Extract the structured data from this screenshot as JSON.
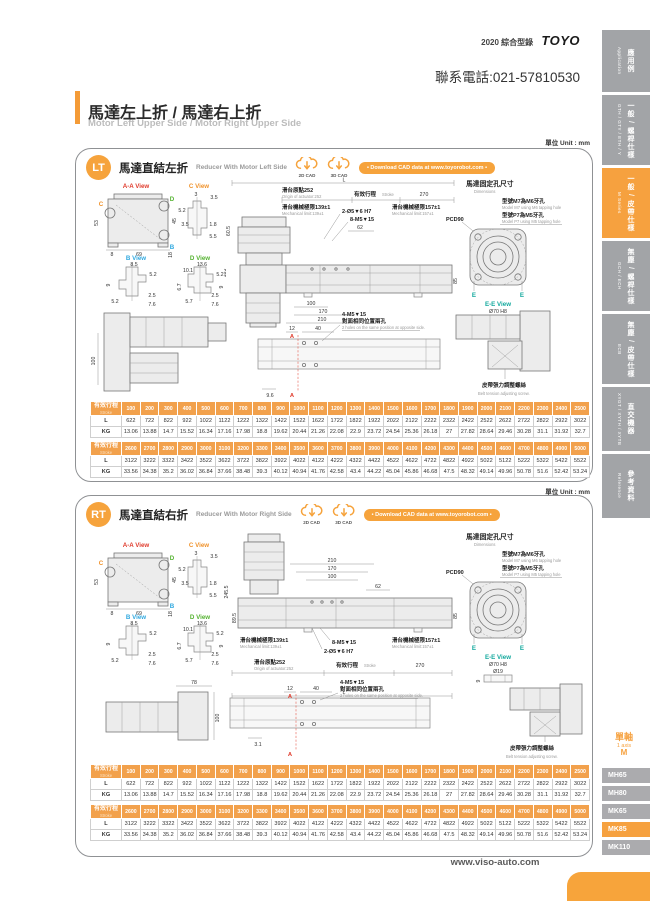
{
  "page": {
    "catalog": "2020  綜合型錄",
    "logo": "TOYO",
    "phone": "聯系電話:021-57810530",
    "title_zh": "馬達左上折 / 馬達右上折",
    "title_en": "Motor Left Upper Side / Motor Right Upper Side",
    "unit": "單位 Unit : mm",
    "footer": "www.viso-auto.com"
  },
  "sidebar": {
    "tabs": [
      {
        "zh": "應用例",
        "en": "Application"
      },
      {
        "zh": "一般 / 螺桿仕樣",
        "en": "GTH / GTY / ETH / Y"
      },
      {
        "zh": "一般 / 皮帶仕樣",
        "en": "M Series"
      },
      {
        "zh": "無塵 / 螺桿仕樣",
        "en": "GCH / ECH"
      },
      {
        "zh": "無塵 / 皮帶仕樣",
        "en": "ECB"
      },
      {
        "zh": "直交機器",
        "en": "XYGT / XYTH / XYTB"
      },
      {
        "zh": "參考資料",
        "en": "Reference"
      }
    ],
    "axis": {
      "zh": "單軸",
      "en": "1 axis",
      "series": "M"
    },
    "models": [
      {
        "label": "MH65"
      },
      {
        "label": "MH80"
      },
      {
        "label": "MK65"
      },
      {
        "label": "MK85"
      },
      {
        "label": "MK110"
      }
    ]
  },
  "panel_lt": {
    "badge": "LT",
    "title_zh": "馬達直結左折",
    "title_en": "Reducer With Motor Left Side",
    "cad2d": "2D CAD",
    "cad3d": "3D CAD",
    "download": "• Download CAD data at www.toyorobot.com •"
  },
  "panel_rt": {
    "badge": "RT",
    "title_zh": "馬達直結右折",
    "title_en": "Reducer With Motor Right Side",
    "cad2d": "2D CAD",
    "cad3d": "3D CAD",
    "download": "• Download CAD data at www.toyorobot.com •"
  },
  "views": {
    "aa": {
      "label": "A-A View",
      "d53": "53",
      "d45": "45",
      "d8": "8",
      "d69": "69",
      "d18": "18",
      "mc": "C",
      "md": "D",
      "mb": "B"
    },
    "c": {
      "label": "C View",
      "d3": "3",
      "d35a": "3.5",
      "d52": "5.2",
      "d35b": "3.5",
      "d18": "1.8",
      "d55": "5.5"
    },
    "b": {
      "label": "B View",
      "d85": "8.5",
      "d52a": "5.2",
      "d9": "9",
      "d52b": "5.2",
      "d25": "2.5",
      "d76": "7.6"
    },
    "d": {
      "label": "D View",
      "d136": "13.6",
      "d101": "10.1",
      "d52a": "5.2",
      "d67": "6.7",
      "d9": "9",
      "d57": "5.7",
      "d25": "2.5",
      "d76": "7.6"
    }
  },
  "mount": {
    "title_zh": "馬達固定孔尺寸",
    "title_en": "Dimensions",
    "m7_zh": "型號M7為M6牙孔",
    "m7_en": "Model M7 using M6 tapping hole",
    "p7_zh": "型號P7為M5牙孔",
    "p7_en": "Model P7 using M5 tapping hole",
    "pcd": "PCD90",
    "e": "E",
    "ee_label": "E-E View",
    "d70": "Ø70 H8",
    "d19": "Ø19",
    "d9": "9"
  },
  "drawing": {
    "l": "L",
    "origin_zh": "滑台原點252",
    "origin_en": "Origin of actuator:252",
    "stroke_zh": "有效行程",
    "stroke_en": "Stroke",
    "d270": "270",
    "mech139_zh": "滑台機械極限139±1",
    "mech139_en": "Mechanical limit:139±1",
    "mech157_zh": "滑台機械極限157±1",
    "mech157_en": "Mechanical limit:157±1",
    "holes_pin": "2-Ø5▼6 H7",
    "holes_m5": "8-M5▼15",
    "d62": "62",
    "d100": "100",
    "d170": "170",
    "d210": "210",
    "d85": "85",
    "d183": "183",
    "d605": "60.5",
    "d2455": "245.5",
    "d895": "89.5",
    "d12": "12",
    "d40": "40",
    "d96": "9.6",
    "d31": "3.1",
    "d78": "78",
    "d100b": "100",
    "m5x4_l1": "4-M5▼15",
    "m5x4_l2": "對面相同位置兩孔",
    "m5x4_en": "2 holes on the same position at opposite side.",
    "belt_zh": "皮帶張力調整螺絲",
    "belt_en": "Belt tension adjusting screw.",
    "a": "A"
  },
  "stroke_table": {
    "header_zh": "有效行程",
    "header_en": "Stroke",
    "row_l": "L",
    "row_kg": "KG",
    "strokes1": [
      100,
      200,
      300,
      400,
      500,
      600,
      700,
      800,
      900,
      1000,
      1100,
      1200,
      1300,
      1400,
      1500,
      1600,
      1700,
      1800,
      1900,
      2000,
      2100,
      2200,
      2300,
      2400,
      2500
    ],
    "L1": [
      622,
      722,
      822,
      922,
      1022,
      1122,
      1222,
      1322,
      1422,
      1522,
      1622,
      1722,
      1822,
      1922,
      2022,
      2122,
      2222,
      2322,
      2422,
      2522,
      2622,
      2722,
      2822,
      2922,
      3022
    ],
    "KG1": [
      13.06,
      13.88,
      14.7,
      15.52,
      16.34,
      17.16,
      17.98,
      18.8,
      19.62,
      20.44,
      21.26,
      22.08,
      22.9,
      23.72,
      24.54,
      25.36,
      26.18,
      27,
      27.82,
      28.64,
      29.46,
      30.28,
      31.1,
      31.92,
      32.7
    ],
    "strokes2": [
      2600,
      2700,
      2800,
      2900,
      3000,
      3100,
      3200,
      3300,
      3400,
      3500,
      3600,
      3700,
      3800,
      3900,
      4000,
      4100,
      4200,
      4300,
      4400,
      4500,
      4600,
      4700,
      4800,
      4900,
      5000
    ],
    "L2": [
      3122,
      3222,
      3322,
      3422,
      3522,
      3622,
      3722,
      3822,
      3922,
      4022,
      4122,
      4222,
      4322,
      4422,
      4522,
      4622,
      4722,
      4822,
      4922,
      5022,
      5122,
      5222,
      5322,
      5422,
      5522
    ],
    "KG2": [
      33.56,
      34.38,
      35.2,
      36.02,
      36.84,
      37.66,
      38.48,
      39.3,
      40.12,
      40.94,
      41.76,
      42.58,
      43.4,
      44.22,
      45.04,
      45.86,
      46.68,
      47.5,
      48.32,
      49.14,
      49.96,
      50.78,
      51.6,
      52.42,
      53.24
    ]
  }
}
